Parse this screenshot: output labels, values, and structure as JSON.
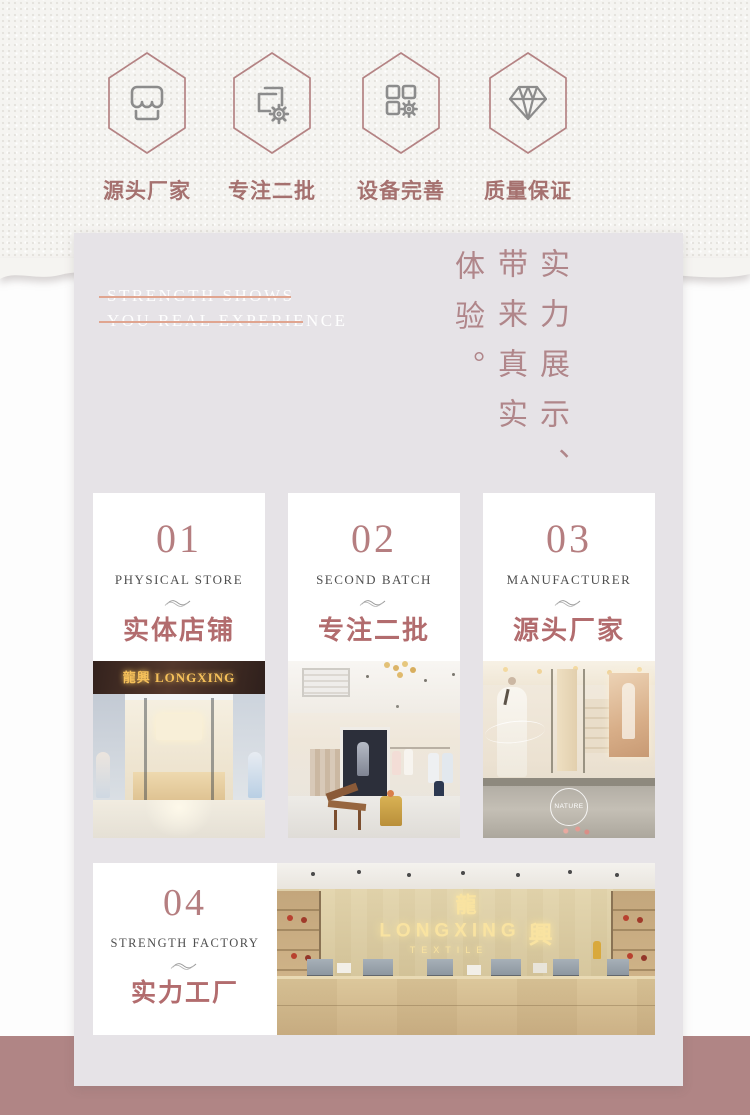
{
  "colors": {
    "accent_rose": "#b26c6e",
    "panel_gray": "#e6e3e7",
    "bottom_pink": "#b08585",
    "hexagon_stroke": "#b48384",
    "sign_gold": "#f5c05a"
  },
  "features": [
    {
      "icon": "storefront-icon",
      "label": "源头厂家"
    },
    {
      "icon": "documents-gear-icon",
      "label": "专注二批"
    },
    {
      "icon": "grid-gear-icon",
      "label": "设备完善"
    },
    {
      "icon": "diamond-icon",
      "label": "质量保证"
    }
  ],
  "strength_panel": {
    "en_line1": "STRENGTH SHOWS",
    "en_line2": "YOU REAL EXPERIENCE",
    "vertical_cols": {
      "right": "实力展示、",
      "middle": "带来真实",
      "left": "体验。"
    }
  },
  "cards": [
    {
      "number": "01",
      "en": "PHYSICAL STORE",
      "cn": "实体店铺",
      "photo": "storefront-photo"
    },
    {
      "number": "02",
      "en": "SECOND BATCH",
      "cn": "专注二批",
      "photo": "boutique-interior-photo"
    },
    {
      "number": "03",
      "en": "MANUFACTURER",
      "cn": "源头厂家",
      "photo": "glass-storefront-photo"
    },
    {
      "number": "04",
      "en": "STRENGTH FACTORY",
      "cn": "实力工厂",
      "photo": "factory-reception-photo"
    }
  ],
  "photos": {
    "storefront_sign": "龍興 LONGXING",
    "reception": {
      "cn_top": "龍",
      "line1": "LONGXING",
      "cn_right": "興",
      "line2": "TEXTILE"
    },
    "nature_badge": "NATURE"
  }
}
